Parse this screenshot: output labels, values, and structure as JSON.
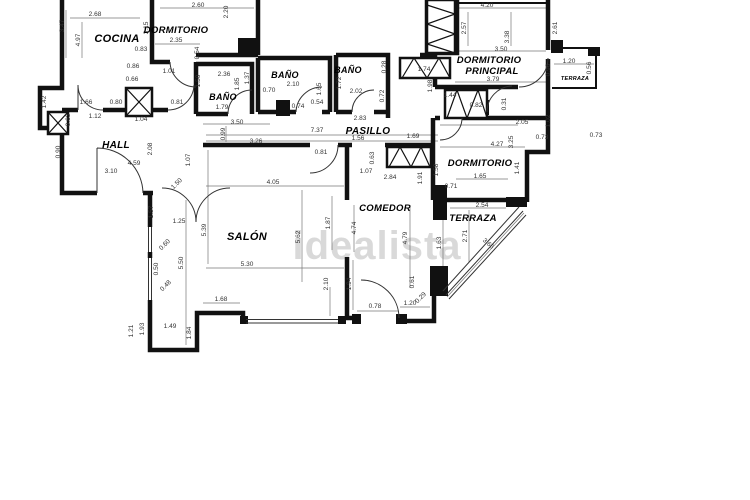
{
  "watermark": {
    "text": "idealista",
    "color": "#d9d9d9"
  },
  "colors": {
    "wall": "#111111",
    "dimension_text": "#333333",
    "background": "#ffffff",
    "watermark": "#d9d9d9"
  },
  "rooms": [
    {
      "label": "COCINA",
      "x": 117,
      "y": 42,
      "size": 11
    },
    {
      "label": "DORMITORIO",
      "x": 176,
      "y": 33,
      "size": 9.5
    },
    {
      "label": "BAÑO",
      "x": 223,
      "y": 100,
      "size": 9
    },
    {
      "label": "BAÑO",
      "x": 285,
      "y": 78,
      "size": 9
    },
    {
      "label": "BAÑO",
      "x": 348,
      "y": 73,
      "size": 9
    },
    {
      "label": "DORMITORIO",
      "x": 489,
      "y": 63,
      "size": 9.5
    },
    {
      "label": "PRINCIPAL",
      "x": 492,
      "y": 74,
      "size": 9.5
    },
    {
      "label": "TERRAZA",
      "x": 575,
      "y": 80,
      "size": 5.5
    },
    {
      "label": "HALL",
      "x": 116,
      "y": 148,
      "size": 10
    },
    {
      "label": "PASILLO",
      "x": 368,
      "y": 134,
      "size": 10
    },
    {
      "label": "SALÓN",
      "x": 247,
      "y": 240,
      "size": 11
    },
    {
      "label": "COMEDOR",
      "x": 385,
      "y": 211,
      "size": 9.5
    },
    {
      "label": "DORMITORIO",
      "x": 480,
      "y": 166,
      "size": 9.5
    },
    {
      "label": "TERRAZA",
      "x": 473,
      "y": 221,
      "size": 9.5
    }
  ],
  "dimensions": [
    {
      "t": "2.68",
      "x": 95,
      "y": 16
    },
    {
      "t": "3.47",
      "x": 64,
      "y": 26,
      "r": 90
    },
    {
      "t": "4.97",
      "x": 80,
      "y": 40,
      "r": 90
    },
    {
      "t": "3.15",
      "x": 148,
      "y": 28,
      "r": 90
    },
    {
      "t": "2.60",
      "x": 198,
      "y": 7
    },
    {
      "t": "2.20",
      "x": 228,
      "y": 12,
      "r": 90
    },
    {
      "t": "2.35",
      "x": 176,
      "y": 42
    },
    {
      "t": "0.83",
      "x": 141,
      "y": 51
    },
    {
      "t": "0.54",
      "x": 199,
      "y": 53,
      "r": 90
    },
    {
      "t": "0.86",
      "x": 133,
      "y": 68
    },
    {
      "t": "0.66",
      "x": 132,
      "y": 81
    },
    {
      "t": "1.01",
      "x": 169,
      "y": 73
    },
    {
      "t": "2.36",
      "x": 224,
      "y": 76
    },
    {
      "t": "1.50",
      "x": 200,
      "y": 81,
      "r": 90
    },
    {
      "t": "1.85",
      "x": 239,
      "y": 84,
      "r": 90
    },
    {
      "t": "1.37",
      "x": 249,
      "y": 78,
      "r": 90
    },
    {
      "t": "1.79",
      "x": 222,
      "y": 109
    },
    {
      "t": "3.50",
      "x": 237,
      "y": 124
    },
    {
      "t": "2.10",
      "x": 293,
      "y": 86
    },
    {
      "t": "0.70",
      "x": 269,
      "y": 92
    },
    {
      "t": "1.65",
      "x": 321,
      "y": 89,
      "r": 90
    },
    {
      "t": "0.74",
      "x": 298,
      "y": 108
    },
    {
      "t": "0.54",
      "x": 317,
      "y": 104
    },
    {
      "t": "2.02",
      "x": 356,
      "y": 93
    },
    {
      "t": "1.72",
      "x": 341,
      "y": 83,
      "r": 90
    },
    {
      "t": "0.28",
      "x": 386,
      "y": 67,
      "r": 90
    },
    {
      "t": "0.72",
      "x": 384,
      "y": 96,
      "r": 90
    },
    {
      "t": "1.74",
      "x": 424,
      "y": 71
    },
    {
      "t": "1.98",
      "x": 432,
      "y": 86,
      "r": 90
    },
    {
      "t": "1.44",
      "x": 450,
      "y": 97
    },
    {
      "t": "0.82",
      "x": 476,
      "y": 107
    },
    {
      "t": "1.66",
      "x": 86,
      "y": 104
    },
    {
      "t": "0.80",
      "x": 116,
      "y": 104
    },
    {
      "t": "0.81",
      "x": 177,
      "y": 104
    },
    {
      "t": "1.42",
      "x": 46,
      "y": 102,
      "r": 90
    },
    {
      "t": "0.63",
      "x": 70,
      "y": 120,
      "r": 90
    },
    {
      "t": "1.12",
      "x": 95,
      "y": 118
    },
    {
      "t": "1.04",
      "x": 141,
      "y": 121
    },
    {
      "t": "0.90",
      "x": 60,
      "y": 152,
      "r": 90
    },
    {
      "t": "4.20",
      "x": 487,
      "y": 7
    },
    {
      "t": "2.57",
      "x": 466,
      "y": 28,
      "r": 90
    },
    {
      "t": "3.38",
      "x": 509,
      "y": 37,
      "r": 90
    },
    {
      "t": "2.61",
      "x": 557,
      "y": 28,
      "r": 90
    },
    {
      "t": "3.50",
      "x": 501,
      "y": 51
    },
    {
      "t": "3.79",
      "x": 493,
      "y": 81
    },
    {
      "t": "1.20",
      "x": 569,
      "y": 63
    },
    {
      "t": "0.96",
      "x": 550,
      "y": 70,
      "r": 90
    },
    {
      "t": "0.56",
      "x": 591,
      "y": 68,
      "r": 90
    },
    {
      "t": "2.83",
      "x": 360,
      "y": 120
    },
    {
      "t": "7.37",
      "x": 317,
      "y": 132
    },
    {
      "t": "1.56",
      "x": 358,
      "y": 140
    },
    {
      "t": "1.69",
      "x": 413,
      "y": 138
    },
    {
      "t": "0.99",
      "x": 225,
      "y": 134,
      "r": 90
    },
    {
      "t": "3.26",
      "x": 256,
      "y": 143
    },
    {
      "t": "0.81",
      "x": 321,
      "y": 154
    },
    {
      "t": "0.63",
      "x": 374,
      "y": 158,
      "r": 90
    },
    {
      "t": "1.07",
      "x": 366,
      "y": 173
    },
    {
      "t": "2.84",
      "x": 390,
      "y": 179
    },
    {
      "t": "2.08",
      "x": 152,
      "y": 149,
      "r": 90
    },
    {
      "t": "4.59",
      "x": 134,
      "y": 165
    },
    {
      "t": "3.10",
      "x": 111,
      "y": 173
    },
    {
      "t": "1.07",
      "x": 190,
      "y": 160,
      "r": 90
    },
    {
      "t": "1.50",
      "x": 178,
      "y": 185,
      "r": 45
    },
    {
      "t": "1.57",
      "x": 153,
      "y": 212,
      "r": 90
    },
    {
      "t": "1.25",
      "x": 179,
      "y": 223
    },
    {
      "t": "0.60",
      "x": 166,
      "y": 246,
      "r": 45
    },
    {
      "t": "0.50",
      "x": 158,
      "y": 269,
      "r": 90
    },
    {
      "t": "0.48",
      "x": 167,
      "y": 287,
      "r": 45
    },
    {
      "t": "4.05",
      "x": 273,
      "y": 184
    },
    {
      "t": "5.39",
      "x": 206,
      "y": 230,
      "r": 90
    },
    {
      "t": "5.62",
      "x": 300,
      "y": 237,
      "r": 90
    },
    {
      "t": "1.87",
      "x": 330,
      "y": 223,
      "r": 90
    },
    {
      "t": "4.74",
      "x": 356,
      "y": 228,
      "r": 90
    },
    {
      "t": "5.50",
      "x": 183,
      "y": 263,
      "r": 90
    },
    {
      "t": "5.30",
      "x": 247,
      "y": 266
    },
    {
      "t": "2.10",
      "x": 328,
      "y": 284,
      "r": 90
    },
    {
      "t": "1.94",
      "x": 351,
      "y": 284,
      "r": 90
    },
    {
      "t": "1.68",
      "x": 221,
      "y": 301
    },
    {
      "t": "1.49",
      "x": 170,
      "y": 328
    },
    {
      "t": "1.93",
      "x": 144,
      "y": 329,
      "r": 90
    },
    {
      "t": "1.21",
      "x": 133,
      "y": 331,
      "r": 90
    },
    {
      "t": "1.84",
      "x": 191,
      "y": 333,
      "r": 90
    },
    {
      "t": "0.78",
      "x": 375,
      "y": 308
    },
    {
      "t": "1.20",
      "x": 410,
      "y": 305
    },
    {
      "t": "0.29",
      "x": 422,
      "y": 299,
      "r": 45
    },
    {
      "t": "0.61",
      "x": 414,
      "y": 282,
      "r": 90
    },
    {
      "t": "2.05",
      "x": 522,
      "y": 124
    },
    {
      "t": "0.73",
      "x": 542,
      "y": 139
    },
    {
      "t": "0.73",
      "x": 596,
      "y": 137
    },
    {
      "t": "0.31",
      "x": 506,
      "y": 104,
      "r": 90
    },
    {
      "t": "1.02",
      "x": 550,
      "y": 121,
      "r": 90
    },
    {
      "t": "4.27",
      "x": 497,
      "y": 146
    },
    {
      "t": "3.25",
      "x": 513,
      "y": 142,
      "r": 90
    },
    {
      "t": "1.65",
      "x": 480,
      "y": 178
    },
    {
      "t": "1.41",
      "x": 519,
      "y": 168,
      "r": 90
    },
    {
      "t": "0.71",
      "x": 451,
      "y": 188
    },
    {
      "t": "1.58",
      "x": 438,
      "y": 170,
      "r": 90
    },
    {
      "t": "1.91",
      "x": 422,
      "y": 178,
      "r": 90
    },
    {
      "t": "2.54",
      "x": 482,
      "y": 207
    },
    {
      "t": "4.79",
      "x": 407,
      "y": 238,
      "r": 90
    },
    {
      "t": "1.63",
      "x": 441,
      "y": 243,
      "r": 90
    },
    {
      "t": "2.71",
      "x": 467,
      "y": 236,
      "r": 90
    },
    {
      "t": "3.66",
      "x": 487,
      "y": 245,
      "r": -42
    }
  ]
}
